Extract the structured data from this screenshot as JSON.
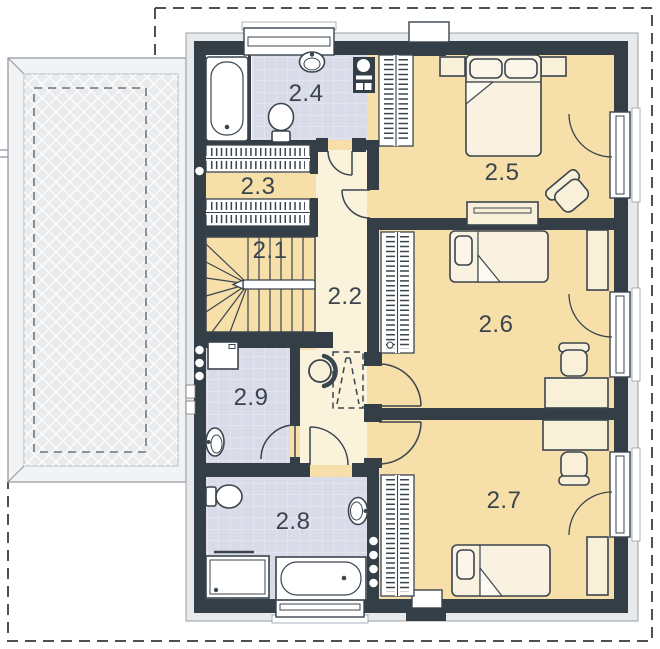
{
  "plan": {
    "type": "floor-plan",
    "floor_labels_visible": [
      "2.1",
      "2.2",
      "2.3",
      "2.4",
      "2.5",
      "2.6",
      "2.7",
      "2.8",
      "2.9"
    ]
  },
  "rooms": [
    {
      "id": "room-2-1",
      "label": "2.1"
    },
    {
      "id": "room-2-2",
      "label": "2.2"
    },
    {
      "id": "room-2-3",
      "label": "2.3"
    },
    {
      "id": "room-2-4",
      "label": "2.4"
    },
    {
      "id": "room-2-5",
      "label": "2.5"
    },
    {
      "id": "room-2-6",
      "label": "2.6"
    },
    {
      "id": "room-2-7",
      "label": "2.7"
    },
    {
      "id": "room-2-8",
      "label": "2.8"
    },
    {
      "id": "room-2-9",
      "label": "2.9"
    }
  ],
  "colors": {
    "wall": "#333E47",
    "outline": "#3A454E",
    "outer_band": "#E7E9EB",
    "bedroom_floor": "#F6DFA9",
    "hall_floor": "#FBF2DC",
    "bath_floor": "#D9DBE9",
    "terrace_fill": "#E9EBED",
    "terrace_band": "#F2F3F5",
    "furniture_fill": "#F8F0D9",
    "sanitary_fill": "#FFFFFF",
    "label_text": "#3A444E",
    "plot_line": "#4A5258"
  }
}
